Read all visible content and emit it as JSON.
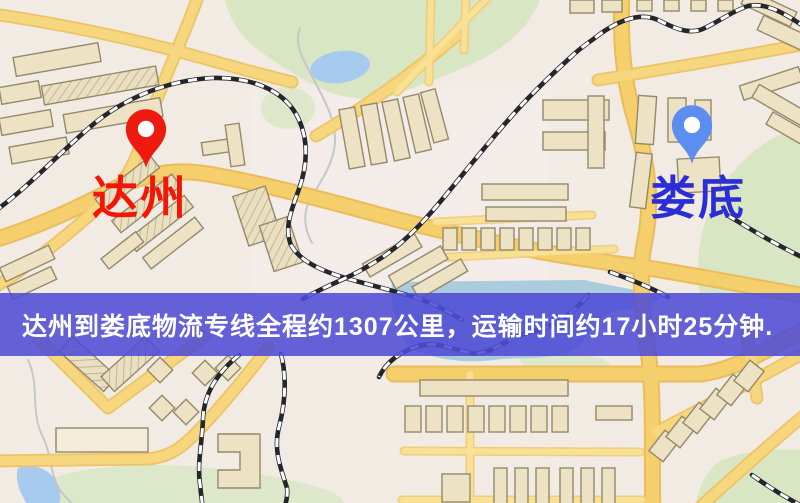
{
  "banner": {
    "text": "达州到娄底物流专线全程约1307公里，运输时间约17小时25分钟.",
    "background_color": "#4f4cd6",
    "text_color": "#ffffff"
  },
  "markers": {
    "origin": {
      "label": "达州",
      "pin_icon": "map-pin",
      "pin_color": "#ee1a10",
      "label_color": "#f51505"
    },
    "destination": {
      "label": "娄底",
      "pin_icon": "map-pin",
      "pin_color": "#5c8ef0",
      "label_color": "#2b2ed6"
    }
  },
  "map": {
    "background_color": "#f2ebe3",
    "road_color": "#f6cf6d",
    "railway_color": "#24262c",
    "building_color": "#ede2c4",
    "park_color": "#d9e6c4",
    "water_color": "#a6cbee"
  }
}
